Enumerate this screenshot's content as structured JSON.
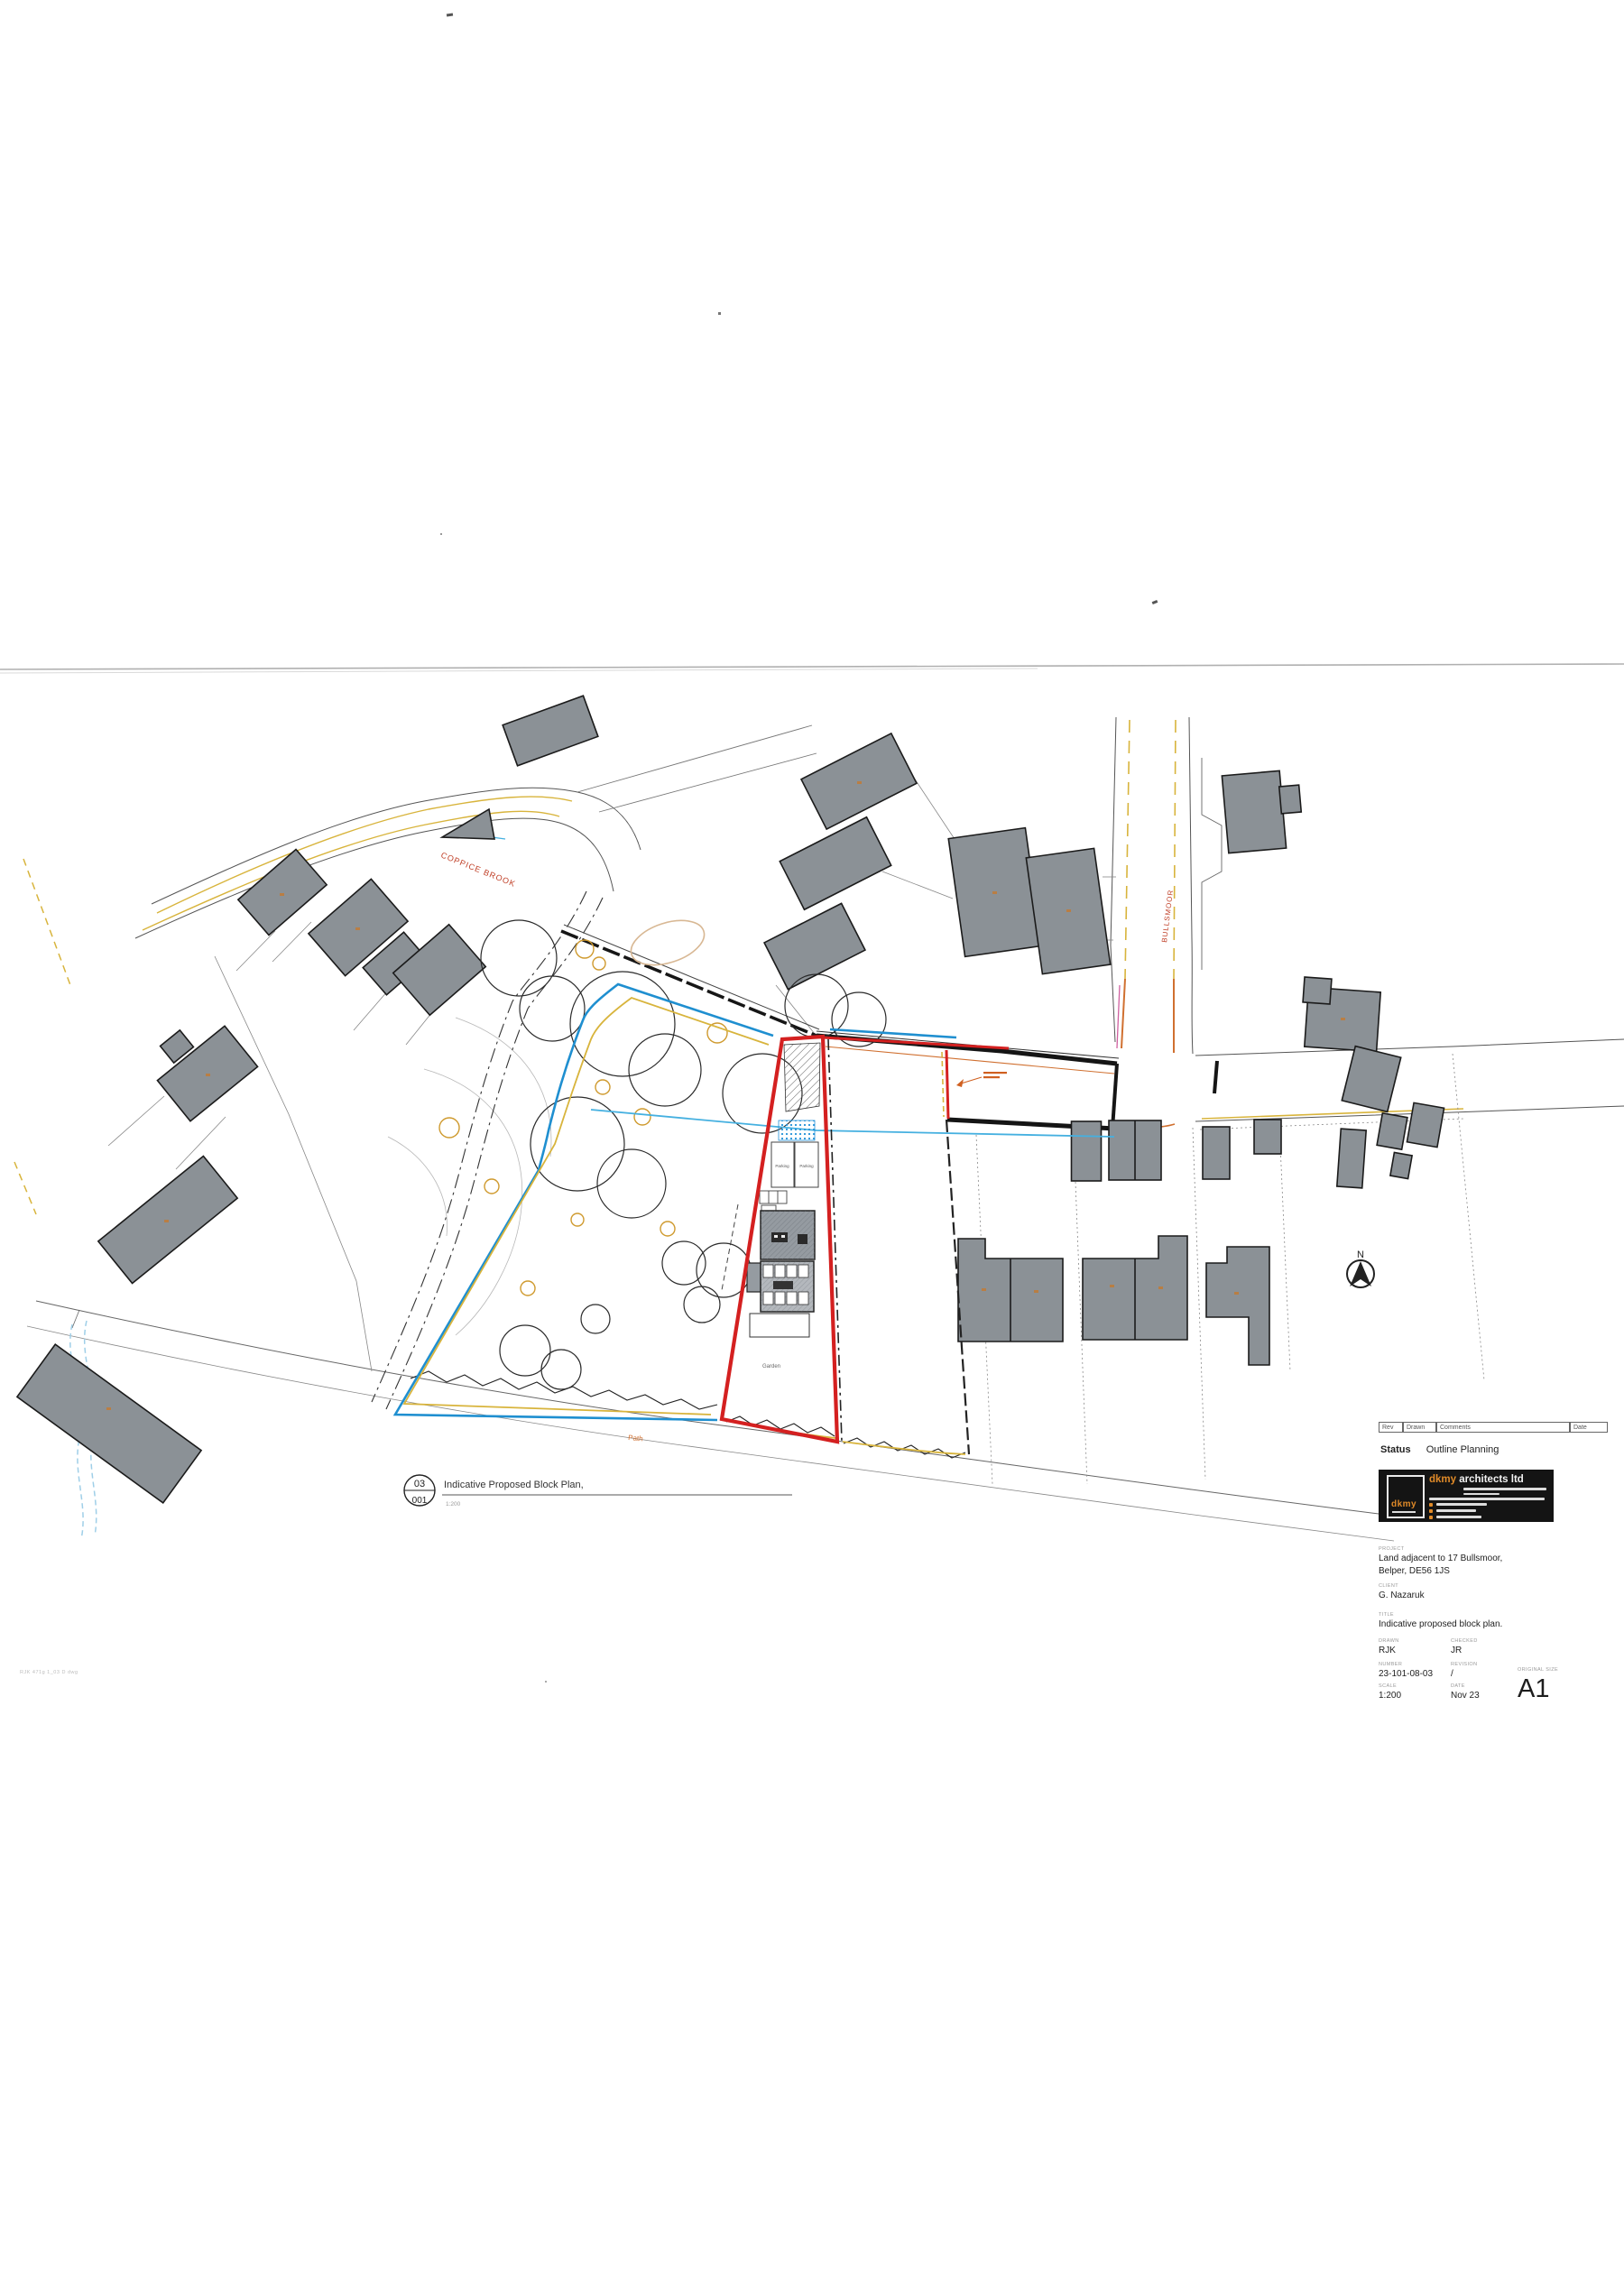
{
  "scan": {
    "file_ref": "RJK 471g 1_03 D dwg"
  },
  "revision_table": {
    "col_rev": "Rev",
    "col_drawn": "Drawn",
    "col_comments": "Comments",
    "col_date": "Date"
  },
  "status": {
    "label": "Status",
    "value": "Outline Planning"
  },
  "logo": {
    "mark_text": "dkmy",
    "brand": "dkmy",
    "brand_rest": " architects ltd"
  },
  "title_block": {
    "project_label": "PROJECT",
    "project_line1": "Land adjacent to 17 Bullsmoor,",
    "project_line2": "Belper, DE56 1JS",
    "client_label": "CLIENT",
    "client_value": "G. Nazaruk",
    "title_label": "TITLE",
    "title_value": "Indicative proposed block plan.",
    "drawn_label": "DRAWN",
    "drawn_value": "RJK",
    "checked_label": "CHECKED",
    "checked_value": "JR",
    "number_label": "NUMBER",
    "number_value": "23-101-08-03",
    "revision_label": "REVISION",
    "revision_value": "/",
    "scale_label": "SCALE",
    "scale_value": "1:200",
    "date_label": "DATE",
    "date_value": "Nov 23",
    "size_label": "ORIGINAL SIZE",
    "size_value": "A1"
  },
  "drawing_label": {
    "detail": "03",
    "sheet": "001",
    "title": "Indicative Proposed Block Plan,",
    "scale": "1:200"
  },
  "plan_labels": {
    "street_coppice": "COPPICE BROOK",
    "street_bullsmoor": "BULLSMOOR",
    "path": "Path",
    "garden": "Garden",
    "parking_left": "Parking",
    "parking_right": "Parking",
    "north": "N"
  },
  "colors": {
    "site_boundary_red": "#d42020",
    "boundary_blue": "#1f8fd0",
    "highway_yellow": "#d8b43c",
    "orange": "#d07030",
    "building_grey": "#8b9196",
    "logo_bg": "#141414",
    "logo_orange": "#e08a28"
  }
}
